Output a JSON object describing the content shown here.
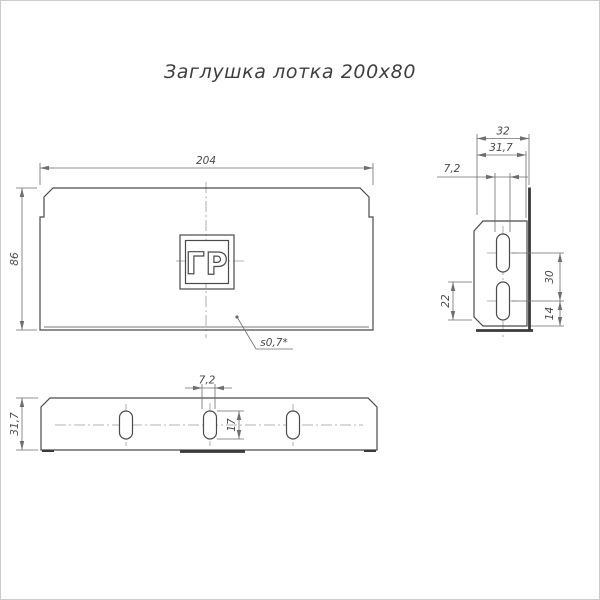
{
  "title": "Заглушка лотка 200х80",
  "logo_text": "ГР",
  "colors": {
    "background": "#ffffff",
    "outline": "#4a4a4a",
    "thick": "#3a3a3a",
    "dim": "#6e6e6e",
    "center": "#9b9b9b",
    "text": "#4a4a4a",
    "title_text": "#3f3f3f",
    "border": "#cccccc"
  },
  "front_view": {
    "width": "204",
    "height": "86",
    "thickness_note": "s0,7*"
  },
  "side_view": {
    "depth": "32",
    "flange_depth": "31,7",
    "slot_width": "7,2",
    "slot_length": "22",
    "slot_spacing": "30",
    "slot_bottom_offset": "14"
  },
  "bottom_view": {
    "flange_width": "31,7",
    "slot_width": "7,2",
    "slot_length": "17"
  }
}
